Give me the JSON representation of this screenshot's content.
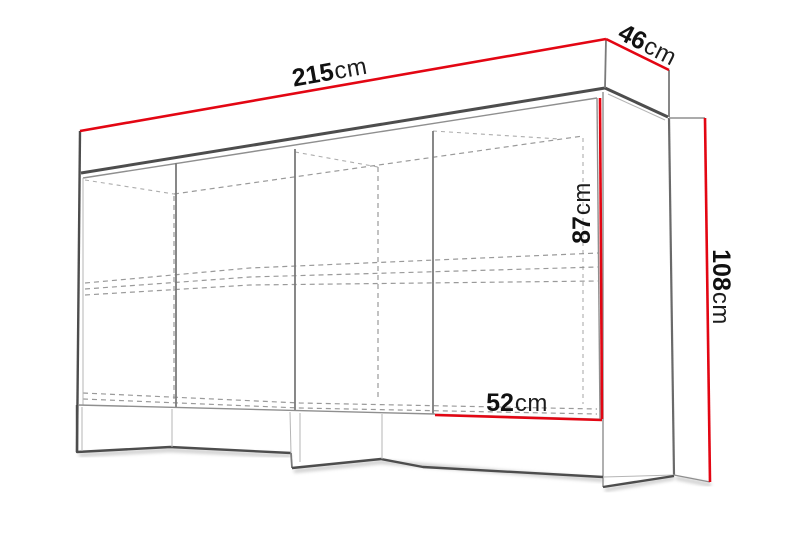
{
  "diagram": {
    "type": "furniture-dimension-drawing",
    "object": "sideboard-cabinet",
    "dimensions": {
      "width": {
        "value": "215",
        "unit": "cm"
      },
      "depth": {
        "value": "46",
        "unit": "cm"
      },
      "body_height": {
        "value": "87",
        "unit": "cm"
      },
      "total_height": {
        "value": "108",
        "unit": "cm"
      },
      "section_width": {
        "value": "52",
        "unit": "cm"
      }
    },
    "colors": {
      "dimension_line": "#e30613",
      "outline_dark": "#4d4d4d",
      "outline_medium": "#7a7a7a",
      "outline_light": "#a6a6a6",
      "dashed_line": "#9a9a9a",
      "label_text": "#111111",
      "background": "#ffffff"
    }
  }
}
